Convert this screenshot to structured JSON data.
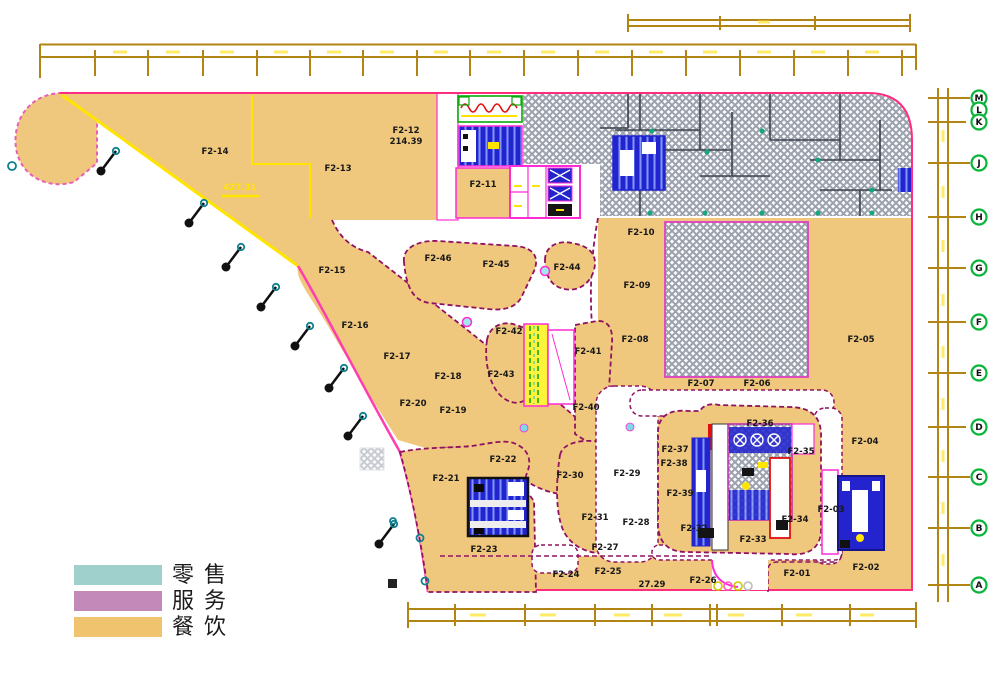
{
  "legend": {
    "items": [
      {
        "label": "零售",
        "color": "#9fd0cb"
      },
      {
        "label": "服务",
        "color": "#c289b9"
      },
      {
        "label": "餐饮",
        "color": "#f0c46e"
      }
    ]
  },
  "rooms": {
    "f2_01": "F2-01",
    "f2_02": "F2-02",
    "f2_03": "F2-03",
    "f2_04": "F2-04",
    "f2_05": "F2-05",
    "f2_06": "F2-06",
    "f2_07": "F2-07",
    "f2_08": "F2-08",
    "f2_09": "F2-09",
    "f2_10": "F2-10",
    "f2_11": "F2-11",
    "f2_12": "F2-12",
    "f2_13": "F2-13",
    "f2_14": "F2-14",
    "f2_15": "F2-15",
    "f2_16": "F2-16",
    "f2_17": "F2-17",
    "f2_18": "F2-18",
    "f2_19": "F2-19",
    "f2_20": "F2-20",
    "f2_21": "F2-21",
    "f2_22": "F2-22",
    "f2_23": "F2-23",
    "f2_24": "F2-24",
    "f2_25": "F2-25",
    "f2_26": "F2-26",
    "f2_27": "F2-27",
    "f2_28": "F2-28",
    "f2_29": "F2-29",
    "f2_30": "F2-30",
    "f2_31": "F2-31",
    "f2_32": "F2-32",
    "f2_33": "F2-33",
    "f2_34": "F2-34",
    "f2_35": "F2-35",
    "f2_36": "F2-36",
    "f2_37": "F2-37",
    "f2_38": "F2-38",
    "f2_39": "F2-39",
    "f2_40": "F2-40",
    "f2_41": "F2-41",
    "f2_42": "F2-42",
    "f2_43": "F2-43",
    "f2_44": "F2-44",
    "f2_45": "F2-45",
    "f2_46": "F2-46"
  },
  "texts": {
    "f2_12_area": "214.39",
    "f2_14_area": "427.31",
    "bottom_area": "27.29"
  },
  "grid_bubbles": [
    "M",
    "L",
    "K",
    "J",
    "H",
    "G",
    "F",
    "E",
    "D",
    "C",
    "B",
    "A"
  ],
  "colors": {
    "dining": "#f0c87d",
    "service": "#c289b9",
    "retail": "#9fd0cb",
    "outline_magenta": "#ff2d7e",
    "facade_yellow": "#ffe400",
    "dimension_gold": "#b08514",
    "core_blue": "#2324cd",
    "grid_bubble_green": "#09b43b"
  }
}
